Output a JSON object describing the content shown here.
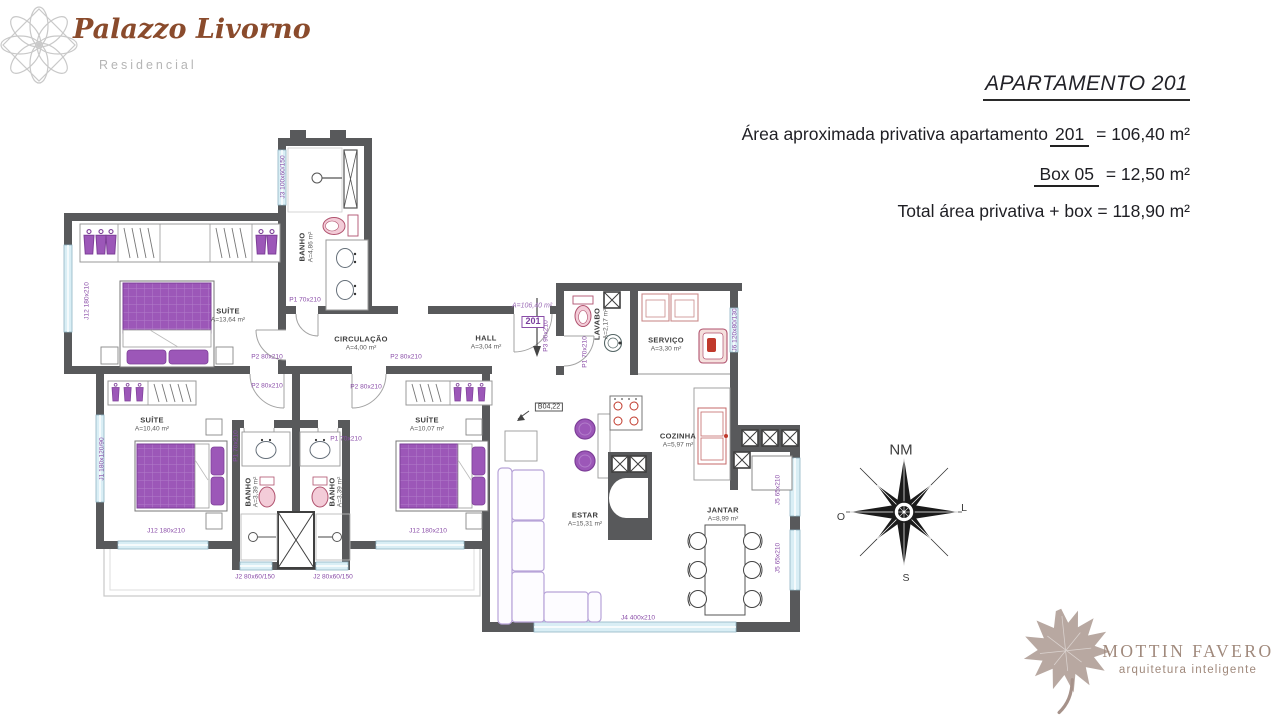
{
  "header": {
    "logo": {
      "name": "Palazzo Livorno",
      "subtitle": "Residencial"
    },
    "title": "APARTAMENTO 201",
    "lines": [
      {
        "pre": "Área aproximada privativa apartamento",
        "u": "201",
        "post": "= 106,40 m²"
      },
      {
        "pre": "",
        "u": "Box 05",
        "post": "= 12,50 m²"
      },
      {
        "pre": "Total área privativa + box = 118,90 m²",
        "u": "",
        "post": ""
      }
    ]
  },
  "plan": {
    "unit_tag": "201",
    "unit_area": "A=106,40 m²",
    "level_marker": "B04,22",
    "labels": [
      {
        "t": "SUÍTE",
        "x": 228,
        "y": 311,
        "c": "room"
      },
      {
        "t": "A=13,64 m²",
        "x": 228,
        "y": 321,
        "c": "area"
      },
      {
        "t": "BANHO",
        "x": 302,
        "y": 247,
        "r": -90,
        "c": "room"
      },
      {
        "t": "A=4,86 m²",
        "x": 312,
        "y": 247,
        "r": -90,
        "c": "area"
      },
      {
        "t": "CIRCULAÇÃO",
        "x": 361,
        "y": 339,
        "c": "room"
      },
      {
        "t": "A=4,00 m²",
        "x": 361,
        "y": 349,
        "c": "area"
      },
      {
        "t": "HALL",
        "x": 486,
        "y": 338,
        "c": "room"
      },
      {
        "t": "A=3,04 m²",
        "x": 486,
        "y": 348,
        "c": "area"
      },
      {
        "t": "LAVABO",
        "x": 597,
        "y": 324,
        "r": -90,
        "c": "room"
      },
      {
        "t": "A=2,17 m²",
        "x": 607,
        "y": 324,
        "r": -90,
        "c": "area"
      },
      {
        "t": "SERVIÇO",
        "x": 666,
        "y": 340,
        "c": "room"
      },
      {
        "t": "A=3,30 m²",
        "x": 666,
        "y": 350,
        "c": "area"
      },
      {
        "t": "COZINHA",
        "x": 678,
        "y": 436,
        "c": "room"
      },
      {
        "t": "A=5,97 m²",
        "x": 678,
        "y": 446,
        "c": "area"
      },
      {
        "t": "SUÍTE",
        "x": 152,
        "y": 420,
        "c": "room"
      },
      {
        "t": "A=10,40 m²",
        "x": 152,
        "y": 430,
        "c": "area"
      },
      {
        "t": "BANHO",
        "x": 248,
        "y": 492,
        "r": -90,
        "c": "room"
      },
      {
        "t": "A=3,39 m²",
        "x": 257,
        "y": 492,
        "r": -90,
        "c": "area"
      },
      {
        "t": "BANHO",
        "x": 332,
        "y": 492,
        "r": -90,
        "c": "room"
      },
      {
        "t": "A=3,39 m²",
        "x": 341,
        "y": 492,
        "r": -90,
        "c": "area"
      },
      {
        "t": "SUÍTE",
        "x": 427,
        "y": 420,
        "c": "room"
      },
      {
        "t": "A=10,07 m²",
        "x": 427,
        "y": 430,
        "c": "area"
      },
      {
        "t": "ESTAR",
        "x": 585,
        "y": 515,
        "c": "room"
      },
      {
        "t": "A=15,31 m²",
        "x": 585,
        "y": 525,
        "c": "area"
      },
      {
        "t": "JANTAR",
        "x": 723,
        "y": 510,
        "c": "room"
      },
      {
        "t": "A=8,99 m²",
        "x": 723,
        "y": 520,
        "c": "area"
      },
      {
        "t": "J3 100x60/150",
        "x": 284,
        "y": 177,
        "r": -90,
        "c": "code"
      },
      {
        "t": "J12 180x210",
        "x": 88,
        "y": 301,
        "r": -90,
        "c": "code"
      },
      {
        "t": "P1 70x210",
        "x": 305,
        "y": 301,
        "c": "code"
      },
      {
        "t": "P2 80x210",
        "x": 267,
        "y": 358,
        "c": "code"
      },
      {
        "t": "P2 80x210",
        "x": 267,
        "y": 387,
        "c": "code"
      },
      {
        "t": "P2 80x210",
        "x": 406,
        "y": 358,
        "c": "code"
      },
      {
        "t": "P2 80x210",
        "x": 366,
        "y": 388,
        "c": "code"
      },
      {
        "t": "P1 70x210",
        "x": 237,
        "y": 446,
        "r": -90,
        "c": "code"
      },
      {
        "t": "P1 70x210",
        "x": 346,
        "y": 440,
        "c": "code"
      },
      {
        "t": "P3 90x210",
        "x": 547,
        "y": 336,
        "r": -90,
        "c": "code"
      },
      {
        "t": "P1 70x210",
        "x": 586,
        "y": 352,
        "r": -90,
        "c": "code"
      },
      {
        "t": "J1 180x120/90",
        "x": 103,
        "y": 459,
        "r": -90,
        "c": "code"
      },
      {
        "t": "J12 180x210",
        "x": 166,
        "y": 532,
        "c": "code"
      },
      {
        "t": "J12 180x210",
        "x": 428,
        "y": 532,
        "c": "code"
      },
      {
        "t": "J2 80x60/150",
        "x": 255,
        "y": 578,
        "c": "code"
      },
      {
        "t": "J2 80x60/150",
        "x": 333,
        "y": 578,
        "c": "code"
      },
      {
        "t": "J4 400x210",
        "x": 638,
        "y": 619,
        "c": "code"
      },
      {
        "t": "J5 65x210",
        "x": 779,
        "y": 490,
        "r": -90,
        "c": "code"
      },
      {
        "t": "J5 65x210",
        "x": 779,
        "y": 558,
        "r": -90,
        "c": "code"
      },
      {
        "t": "J6 120x80/130",
        "x": 736,
        "y": 330,
        "r": -90,
        "c": "code"
      },
      {
        "t": "A=106,40 m²",
        "x": 532,
        "y": 306,
        "c": "pitalic"
      },
      {
        "t": "201",
        "x": 533,
        "y": 322,
        "c": "tag"
      },
      {
        "t": "B04,22",
        "x": 549,
        "y": 407,
        "c": "marker"
      }
    ]
  },
  "compass": {
    "n": "NM",
    "w": "O",
    "e": "L",
    "s": "S"
  },
  "footer": {
    "brand": "MOTTIN FAVERO",
    "tagline": "arquitetura inteligente"
  },
  "colors": {
    "wall": "#58595b",
    "window": "#d9eef5",
    "furniture_purple": "#9c57b8",
    "code_purple": "#8a4da8",
    "fixture_pink": "#f3ccd8",
    "brand_brown": "#8a4b2c",
    "brand_taupe": "#a0897c"
  }
}
